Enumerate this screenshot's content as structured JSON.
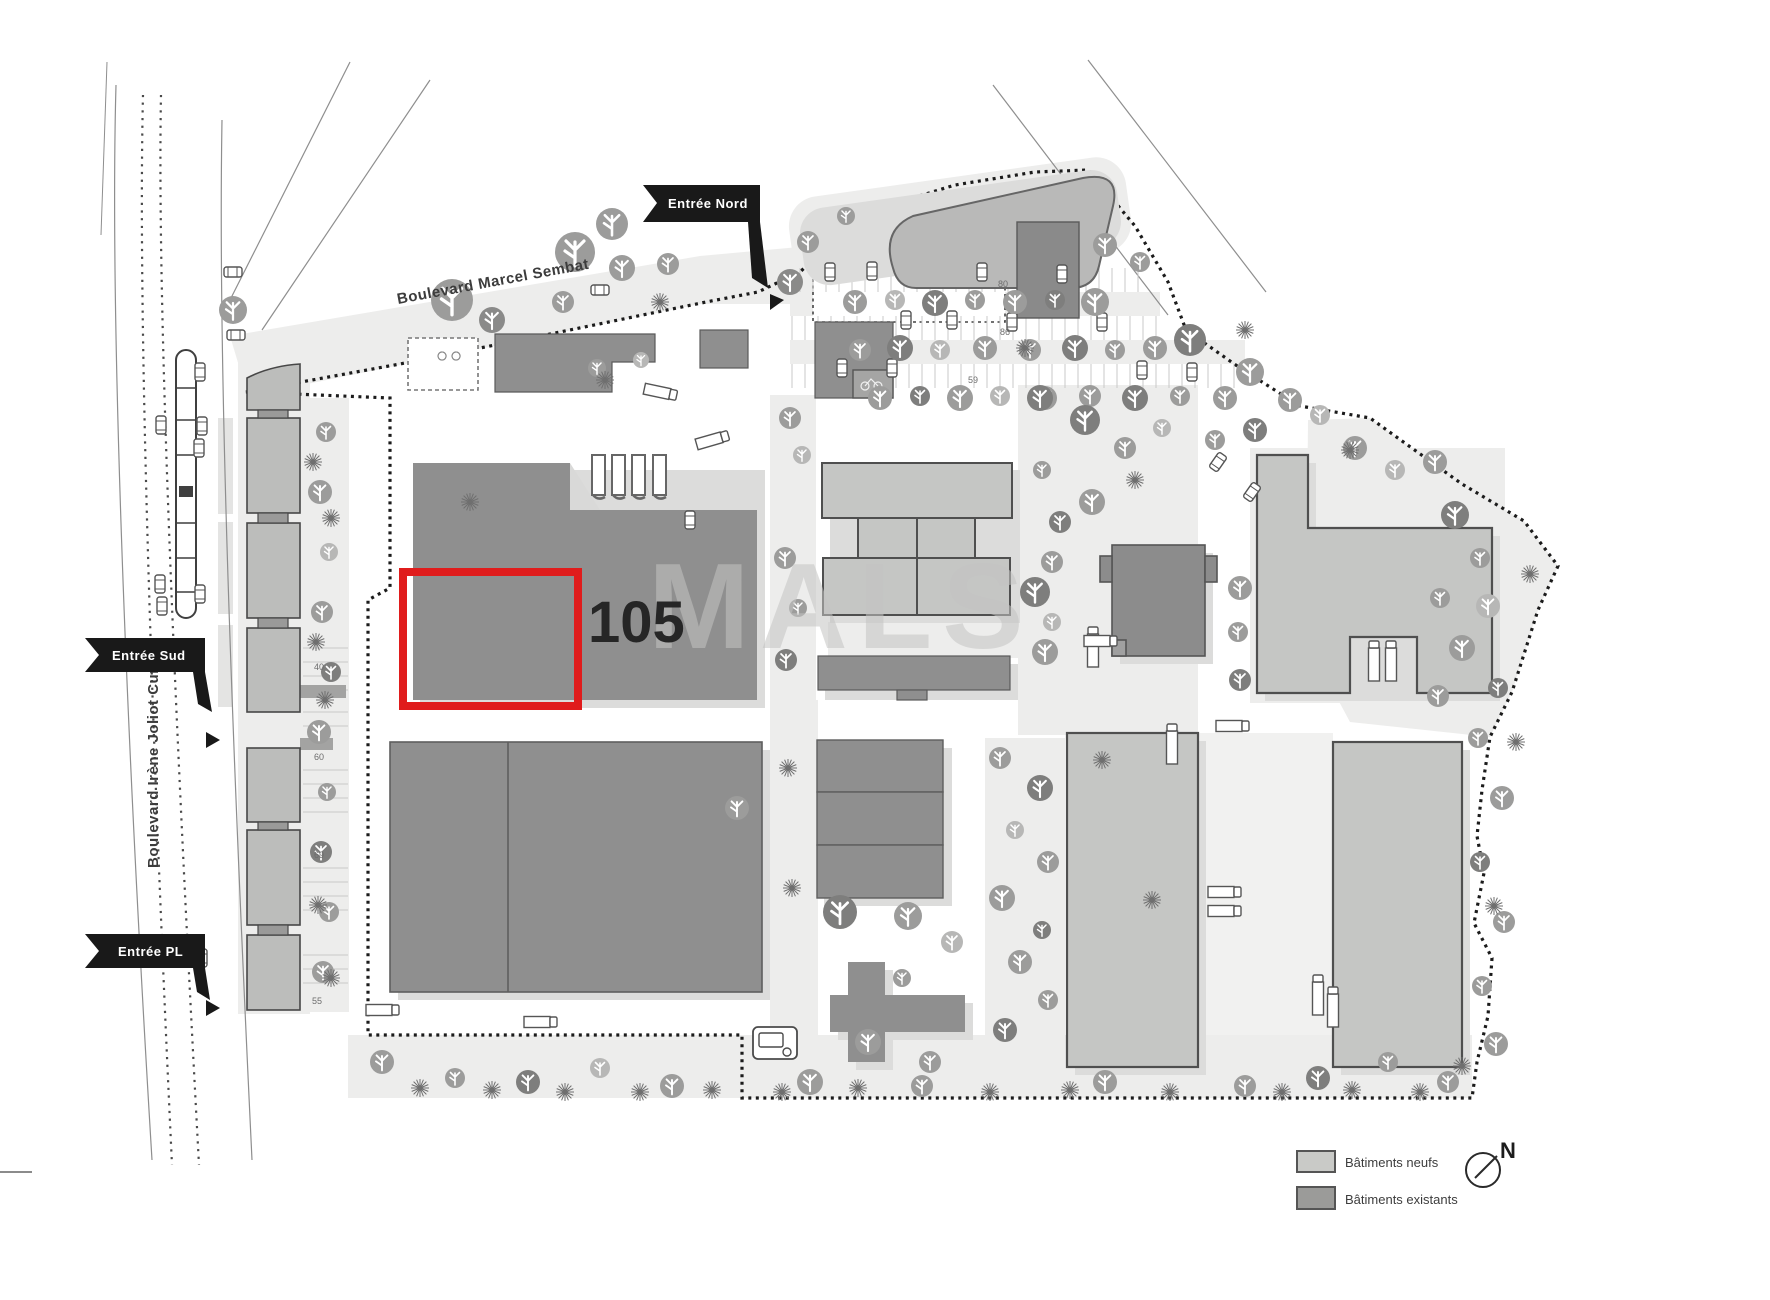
{
  "entrances": {
    "nord": "Entrée Nord",
    "sud": "Entrée Sud",
    "pl": "Entrée PL"
  },
  "streets": {
    "marcel_sembat": "Boulevard Marcel Sembat",
    "joliot_curie": "Boulevard Irène Joliot Curie"
  },
  "parcel": {
    "number": "105",
    "highlight_color": "#e01c1c"
  },
  "watermark": {
    "text": "MALS"
  },
  "legend": {
    "items": [
      {
        "label": "Bâtiments neufs",
        "color": "#c9cac7"
      },
      {
        "label": "Bâtiments existants",
        "color": "#9b9b99"
      }
    ]
  },
  "compass": {
    "label": "N"
  },
  "parking_counts": {
    "left_strip": [
      "40",
      "60",
      "69",
      "55"
    ],
    "north_lot": [
      "80",
      "86",
      "59"
    ]
  },
  "colors": {
    "building_new": "#c5c6c4",
    "building_existing": "#8f8f8f",
    "ground": "#ededec",
    "boundary": "#1b1b1b"
  }
}
